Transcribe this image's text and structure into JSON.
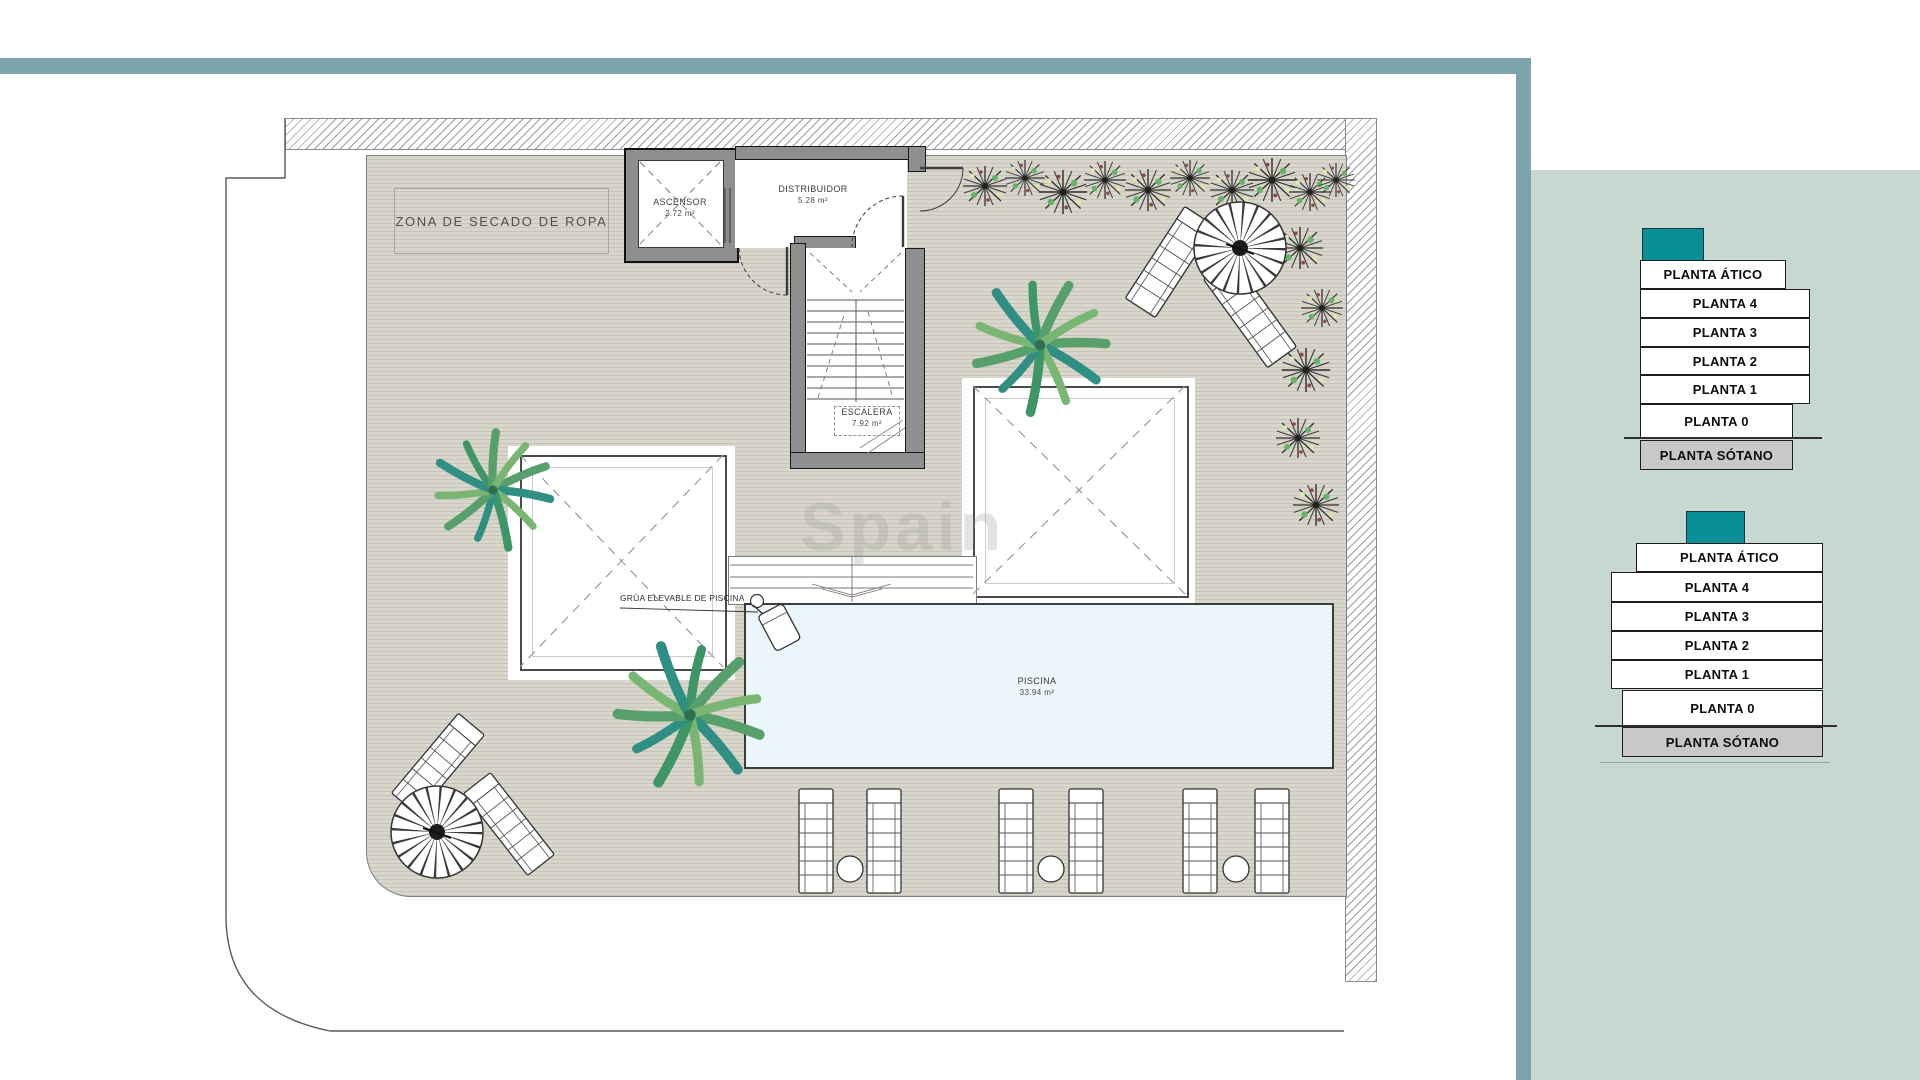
{
  "colors": {
    "accent": "#0a8f96",
    "frame": "#7da4ac",
    "panel": "#c6d8d0",
    "sotano": "#c8c8c8",
    "pool": "#eaf6f9",
    "deck": "#d8d5cb",
    "wall": "#8f8f8f"
  },
  "plan": {
    "drying_zone_label": "ZONA DE SECADO DE ROPA",
    "elevator": {
      "name": "ASCENSOR",
      "area": "2.72 m²"
    },
    "hall": {
      "name": "DISTRIBUIDOR",
      "area": "5.28 m²"
    },
    "stairs": {
      "name": "ESCALERA",
      "area": "7.92 m²"
    },
    "pool": {
      "name": "PISCINA",
      "area": "33.94 m²"
    },
    "pool_crane_label": "GRÚA ELEVABLE DE PISCINA",
    "watermark": "Spain"
  },
  "floor_selector": {
    "stacks": [
      {
        "name": "block-a",
        "floors": [
          "PLANTA ÁTICO",
          "PLANTA 4",
          "PLANTA 3",
          "PLANTA 2",
          "PLANTA 1",
          "PLANTA 0",
          "PLANTA SÓTANO"
        ]
      },
      {
        "name": "block-b",
        "floors": [
          "PLANTA ÁTICO",
          "PLANTA 4",
          "PLANTA 3",
          "PLANTA 2",
          "PLANTA 1",
          "PLANTA 0",
          "PLANTA SÓTANO"
        ]
      }
    ]
  }
}
